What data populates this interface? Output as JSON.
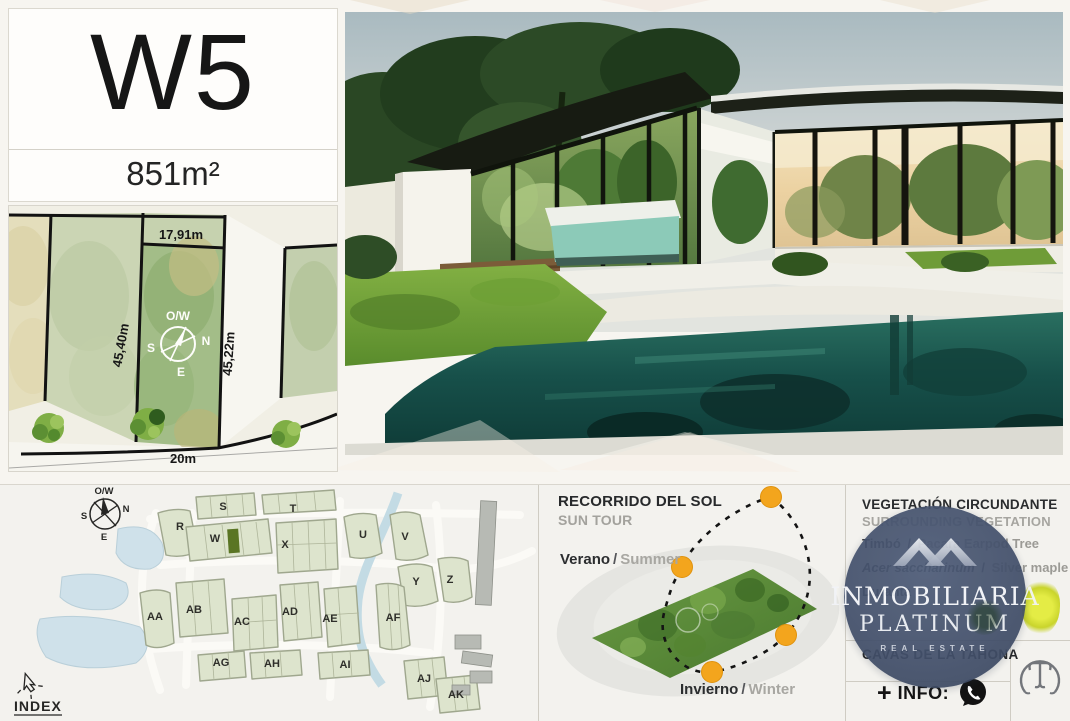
{
  "lot": {
    "id": "W5",
    "area": "851m²"
  },
  "colors": {
    "accent_orange": "#F2A41C",
    "brand_navy": "#43506B",
    "map_water": "#CFE1EA",
    "highlight_lot": "#5A7524"
  },
  "lot_plan": {
    "dim_top": "17,91m",
    "dim_left": "45,40m",
    "dim_right": "45,22m",
    "dim_bottom": "20m",
    "compass": {
      "top": "O/W",
      "right": "N",
      "left": "S",
      "bottom": "E"
    }
  },
  "site_map": {
    "index_label": "INDEX",
    "compass": {
      "top": "O/W",
      "right": "N",
      "left": "S",
      "bottom": "E"
    },
    "blocks": [
      "R",
      "S",
      "W",
      "T",
      "X",
      "U",
      "V",
      "Y",
      "Z",
      "AA",
      "AB",
      "AC",
      "AD",
      "AE",
      "AF",
      "AG",
      "AH",
      "AI",
      "AJ",
      "AK"
    ]
  },
  "sun_tour": {
    "title": "RECORRIDO DEL SOL",
    "subtitle": "SUN TOUR",
    "summer": {
      "es": "Verano",
      "sep": "/",
      "en": "Summer"
    },
    "winter": {
      "es": "Invierno",
      "sep": "/",
      "en": "Winter"
    }
  },
  "vegetation": {
    "title": "VEGETACIÓN CIRCUNDANTE",
    "subtitle": "SURROUNDING VEGETATION",
    "plants": [
      {
        "name": "Timbó",
        "sep": "/",
        "common": "Pacara Earpod Tree"
      },
      {
        "name": "Acer saccharinum",
        "sep": "/",
        "common": "Silver maple"
      },
      {
        "name": "Duranta",
        "sep": "",
        "common": ""
      }
    ]
  },
  "brand": {
    "line1": "INMOBILIARIA",
    "line2": "PLATINUM",
    "line3": "REAL ESTATE",
    "development": "CAVAS DE LA TAHONA",
    "info_plus": "+",
    "info_label": "INFO:"
  }
}
